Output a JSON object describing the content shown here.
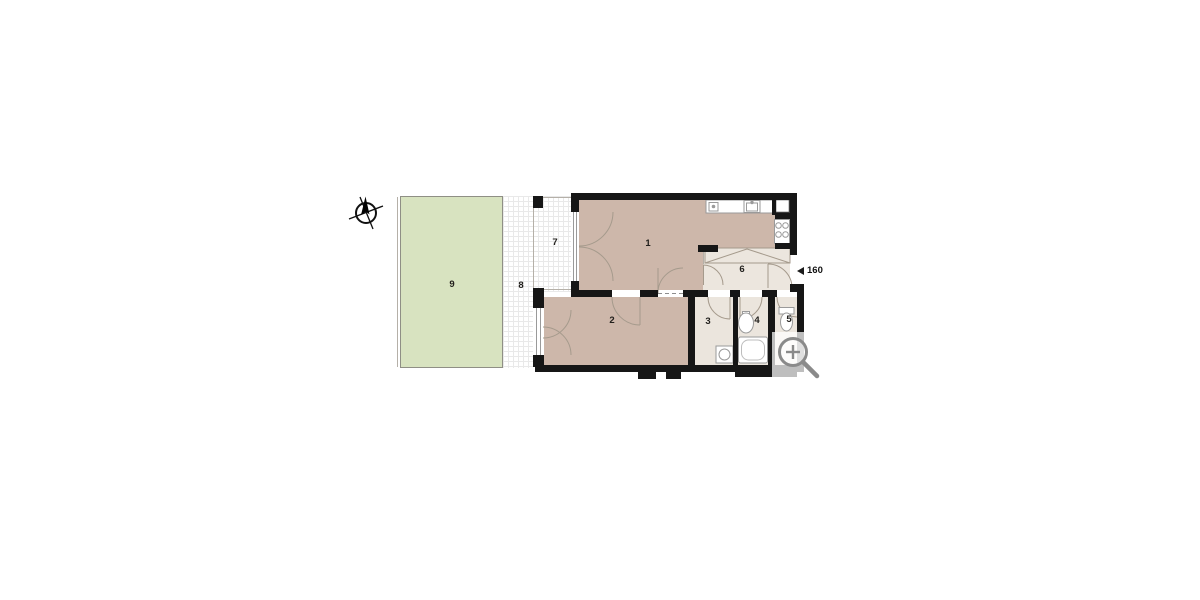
{
  "floorplan": {
    "rooms": [
      {
        "label": "1",
        "fill": "#cdb7aa"
      },
      {
        "label": "2",
        "fill": "#cdb7aa"
      },
      {
        "label": "3",
        "fill": "#ebe5dd"
      },
      {
        "label": "4",
        "fill": "#ebe5dd"
      },
      {
        "label": "5",
        "fill": "#ebe5dd"
      },
      {
        "label": "6",
        "fill": "#ece6de"
      },
      {
        "label": "7",
        "fill": "#ffffff"
      },
      {
        "label": "8",
        "fill": "#ffffff"
      },
      {
        "label": "9",
        "fill": "#d8e3c0"
      }
    ],
    "entrance_marker": {
      "icon": "left-triangle-icon",
      "value": "160"
    },
    "icons": {
      "compass": "compass-north-icon",
      "zoom": "magnifier-plus-icon"
    },
    "fixtures": [
      "kitchen-counter",
      "kitchen-sink",
      "stove-burners",
      "corner-unit",
      "washing-machine",
      "bathroom-sink",
      "bathtub",
      "toilet",
      "sliding-wardrobe"
    ],
    "colors": {
      "wall": "#161616",
      "room_main": "#cdb7aa",
      "room_service": "#ebe5dd",
      "garden": "#d8e3c0",
      "door_arc": "#a59a8c",
      "fixture_stroke": "#9a9a9a",
      "tile_grid": "#e9e9e9",
      "zoom_icon": "#8a8a8a",
      "background": "#ffffff"
    }
  }
}
